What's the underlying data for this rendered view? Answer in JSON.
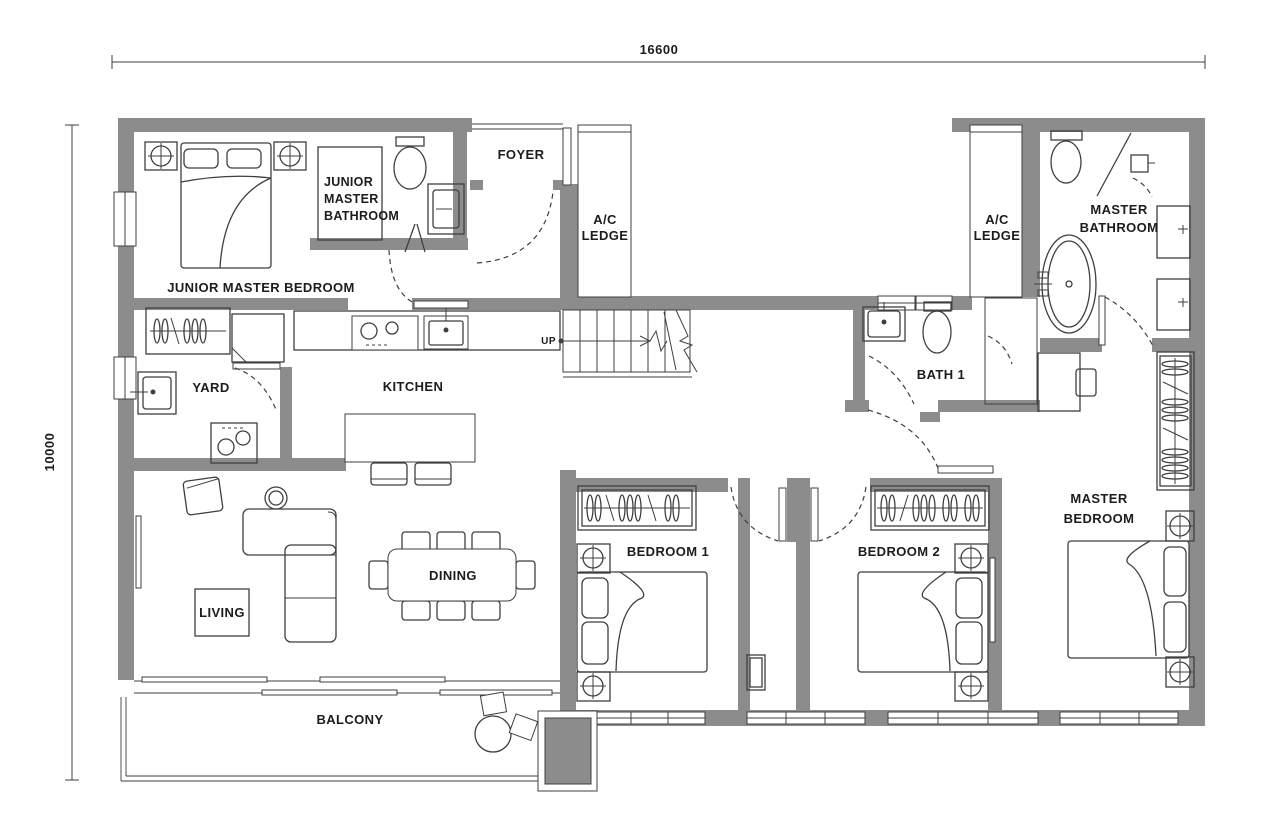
{
  "colors": {
    "wall": "#8c8c8c",
    "line": "#3f3f3f",
    "text": "#1c1c1c",
    "bg": "#ffffff"
  },
  "dimensions": {
    "width_label": "16600",
    "height_label": "10000"
  },
  "rooms": {
    "foyer": {
      "label": "FOYER"
    },
    "ac_ledge_left": {
      "line1": "A/C",
      "line2": "LEDGE"
    },
    "ac_ledge_right": {
      "line1": "A/C",
      "line2": "LEDGE"
    },
    "junior_master_bathroom": {
      "line1": "JUNIOR",
      "line2": "MASTER",
      "line3": "BATHROOM"
    },
    "junior_master_bedroom": {
      "label": "JUNIOR MASTER BEDROOM"
    },
    "master_bathroom": {
      "line1": "MASTER",
      "line2": "BATHROOM"
    },
    "bath_1": {
      "label": "BATH 1"
    },
    "yard": {
      "label": "YARD"
    },
    "kitchen": {
      "label": "KITCHEN"
    },
    "living": {
      "label": "LIVING"
    },
    "dining": {
      "label": "DINING"
    },
    "bedroom_1": {
      "label": "BEDROOM 1"
    },
    "bedroom_2": {
      "label": "BEDROOM 2"
    },
    "master_bedroom": {
      "line1": "MASTER",
      "line2": "BEDROOM"
    },
    "balcony": {
      "label": "BALCONY"
    }
  },
  "stairs": {
    "direction_label": "UP"
  }
}
